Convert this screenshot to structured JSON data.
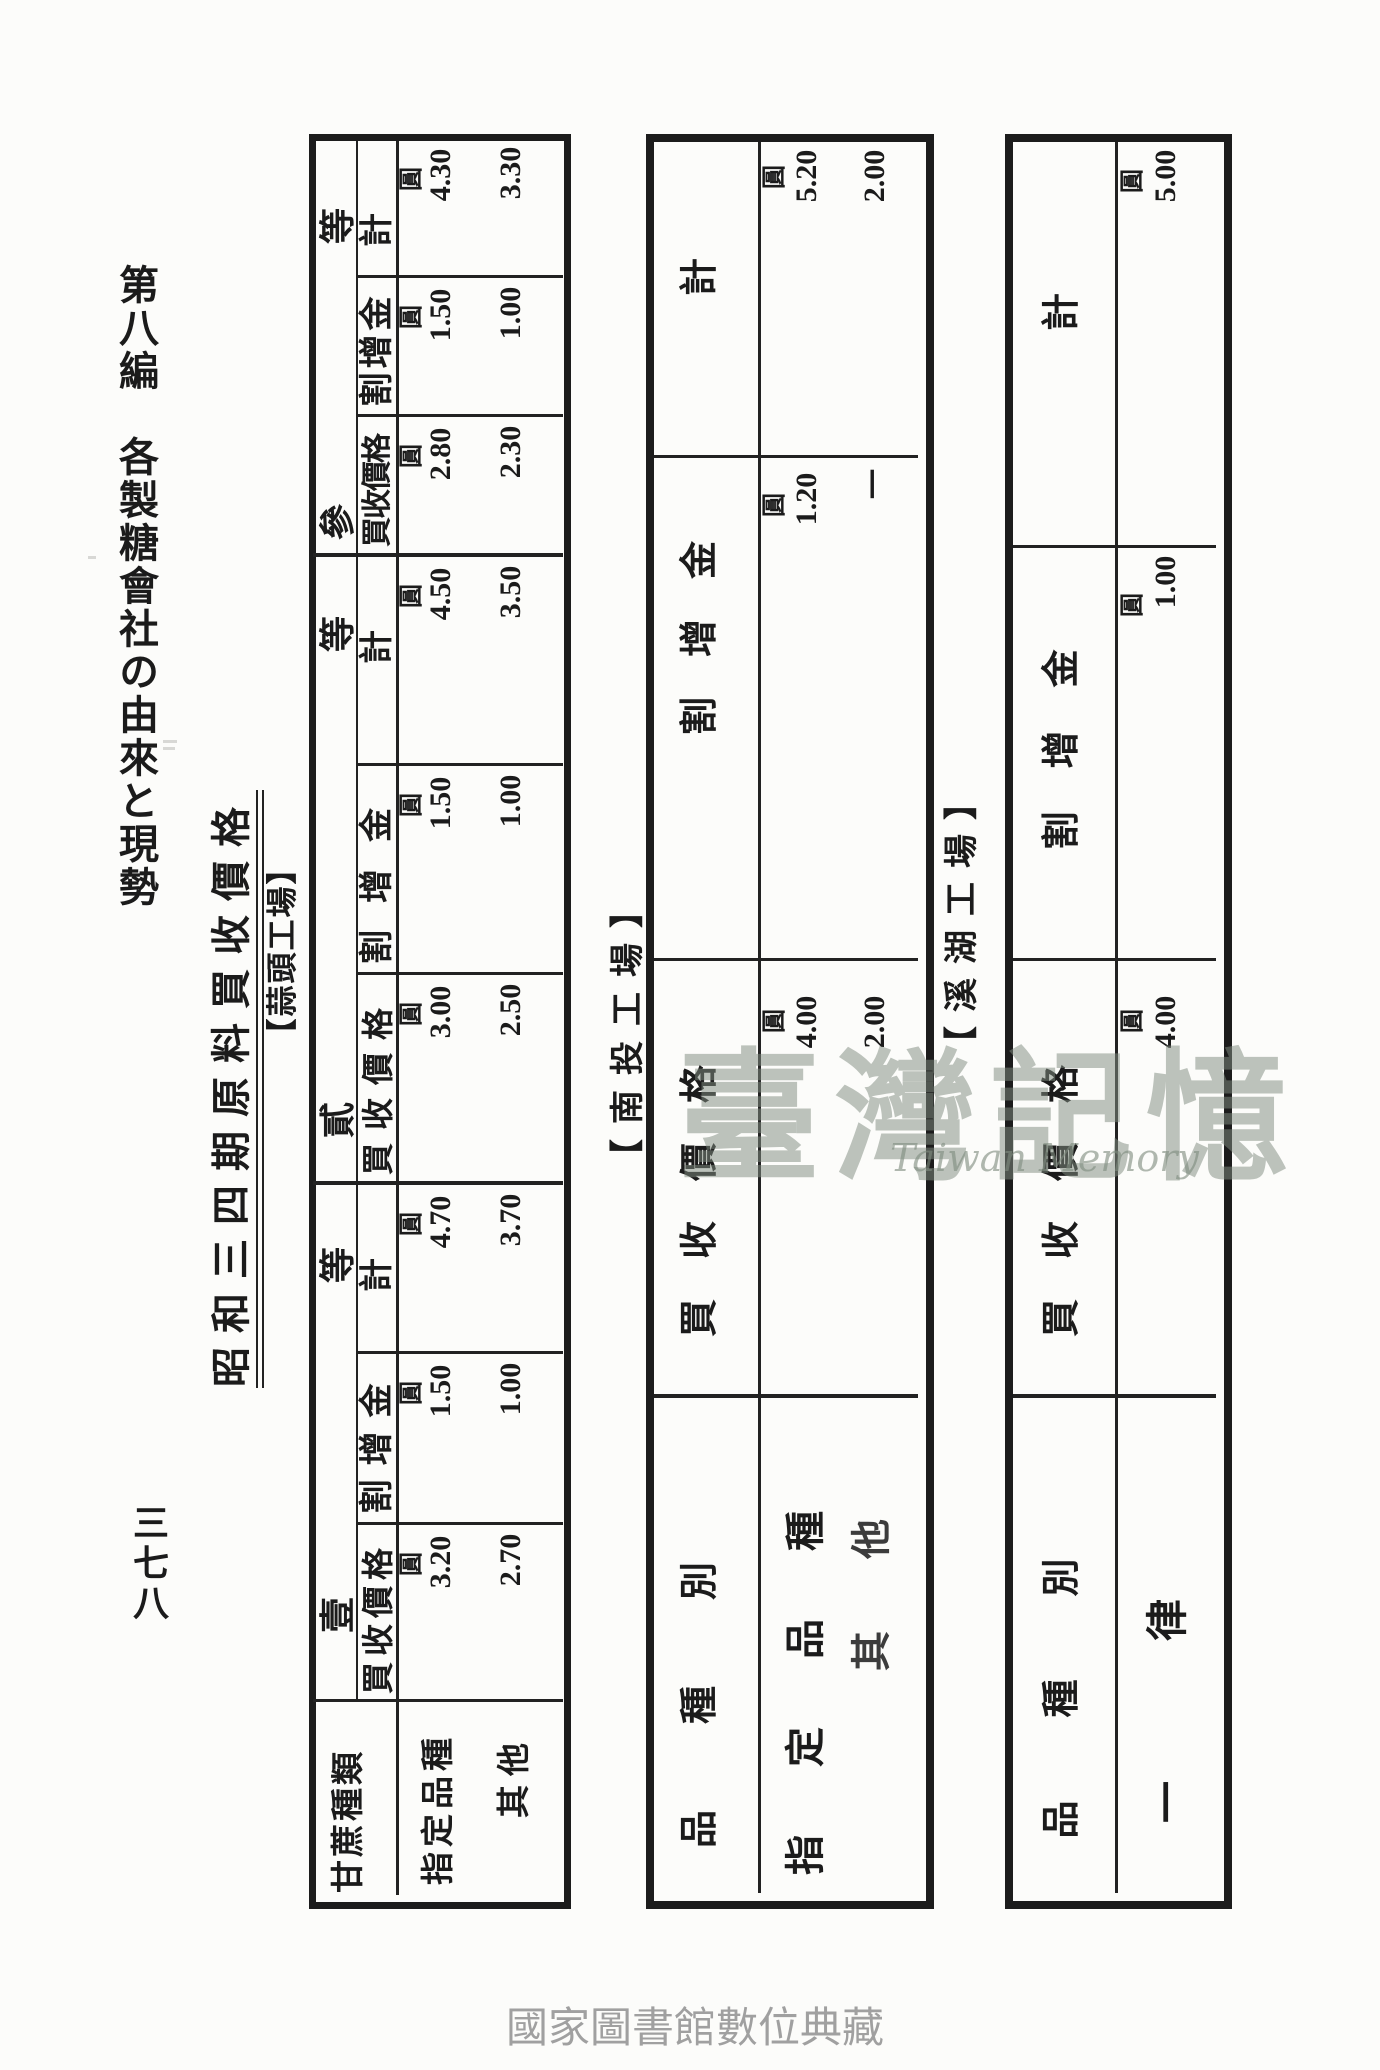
{
  "page": {
    "edition_header": "第八編　各製糖會社の由來と現勢",
    "page_number": "三七八",
    "title": "昭和三四期原料買收價格",
    "caption": "國家圖書館數位典藏",
    "watermark": {
      "cjk": "臺灣記憶",
      "latin": "Taiwan Memory"
    },
    "yen": "圓"
  },
  "factories": [
    {
      "label": "【蒜頭工場】"
    },
    {
      "label": "【南投工場】"
    },
    {
      "label": "【溪湖工場】"
    }
  ],
  "t1": {
    "factory": "蒜頭工場",
    "row_headers": {
      "type_col": "甘蔗種類",
      "row1": "指定品種",
      "row2": "其他"
    },
    "columns": [
      {
        "group_char": "等",
        "label": "計",
        "row1": "4.30",
        "row2": "3.30"
      },
      {
        "group_char": "",
        "label": "割增金",
        "row1": "1.50",
        "row2": "1.00"
      },
      {
        "group_char": "參",
        "label": "買收價格",
        "row1": "2.80",
        "row2": "2.30"
      },
      {
        "group_char": "等",
        "label": "計",
        "row1": "4.50",
        "row2": "3.50"
      },
      {
        "group_char": "",
        "label": "割增金",
        "row1": "1.50",
        "row2": "1.00"
      },
      {
        "group_char": "貳",
        "label": "買收價格",
        "row1": "3.00",
        "row2": "2.50"
      },
      {
        "group_char": "等",
        "label": "計",
        "row1": "4.70",
        "row2": "3.70"
      },
      {
        "group_char": "",
        "label": "割增金",
        "row1": "1.50",
        "row2": "1.00"
      },
      {
        "group_char": "壹",
        "label": "買收價格",
        "row1": "3.20",
        "row2": "2.70"
      }
    ]
  },
  "t2": {
    "factory": "南投工場",
    "row_headers": {
      "type_col": "品種別",
      "row1": "指定品種",
      "row2": "其他"
    },
    "columns": [
      {
        "label": "計",
        "row1": "5.20",
        "row2": "2.00"
      },
      {
        "label": "割增金",
        "row1": "1.20",
        "row2": "一"
      },
      {
        "label": "買收價格",
        "row1": "4.00",
        "row2": "2.00"
      }
    ]
  },
  "t3": {
    "factory": "溪湖工場",
    "row_headers": {
      "type_col": "品種別",
      "row1": "一律"
    },
    "columns": [
      {
        "label": "計",
        "row1": "5.00"
      },
      {
        "label": "割增金",
        "row1": "1.00"
      },
      {
        "label": "買收價格",
        "row1": "4.00"
      }
    ]
  }
}
